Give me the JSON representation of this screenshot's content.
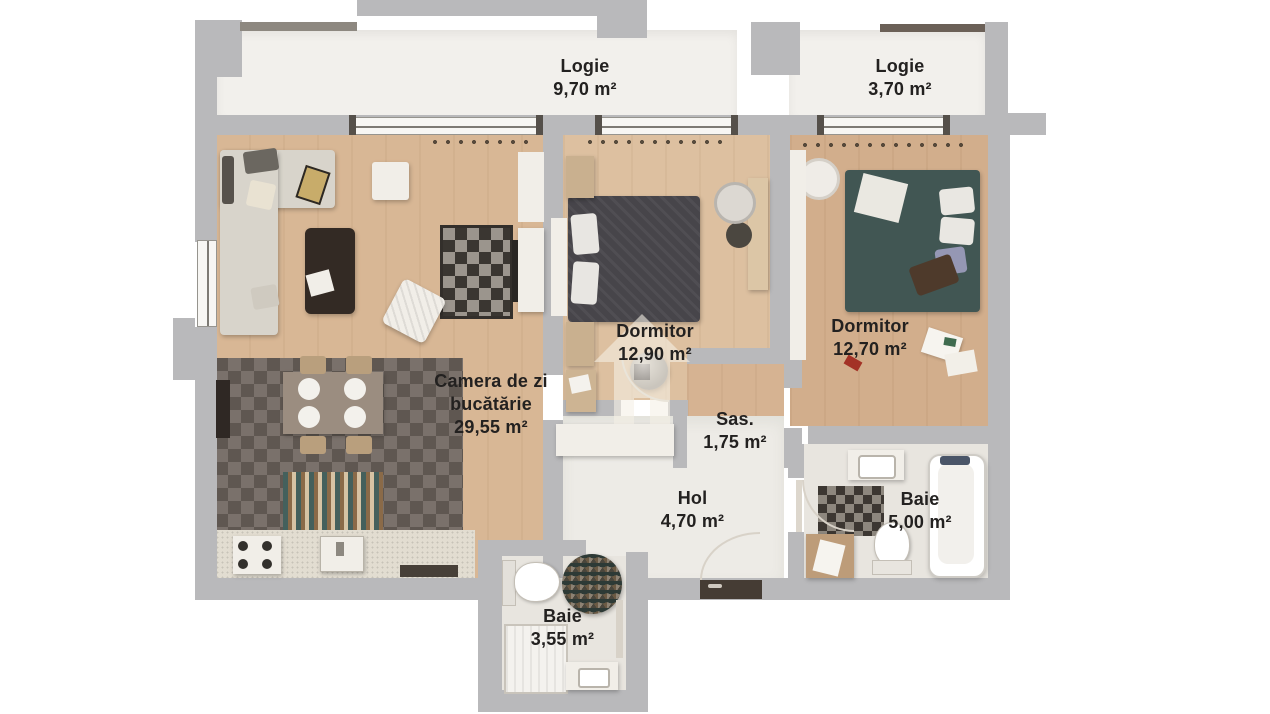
{
  "plan_title": "apartment-floor-plan",
  "palette": {
    "wall": "#b9b9bb",
    "wood_living": "#d8b795",
    "wood_bedroom_1": "#ddc0a0",
    "wood_bedroom_2": "#d2ae8c",
    "kitchen_tile": "#6f655e",
    "hall_floor": "#edebe6",
    "bath_floor": "#e8e5df",
    "label_ink": "#232120"
  },
  "watermark": {
    "icon": "house-logo"
  },
  "rooms": [
    {
      "id": "logie-1",
      "name": "Logie",
      "area": "9,70 m²"
    },
    {
      "id": "logie-2",
      "name": "Logie",
      "area": "3,70 m²"
    },
    {
      "id": "dormitor-1",
      "name": "Dormitor",
      "area": "12,90 m²"
    },
    {
      "id": "dormitor-2",
      "name": "Dormitor",
      "area": "12,70 m²"
    },
    {
      "id": "camera-de-zi",
      "name": "Camera de zi bucătărie",
      "area": "29,55 m²"
    },
    {
      "id": "sas",
      "name": "Sas.",
      "area": "1,75 m²"
    },
    {
      "id": "hol",
      "name": "Hol",
      "area": "4,70 m²"
    },
    {
      "id": "baie-1",
      "name": "Baie",
      "area": "5,00 m²"
    },
    {
      "id": "baie-2",
      "name": "Baie",
      "area": "3,55 m²"
    }
  ]
}
